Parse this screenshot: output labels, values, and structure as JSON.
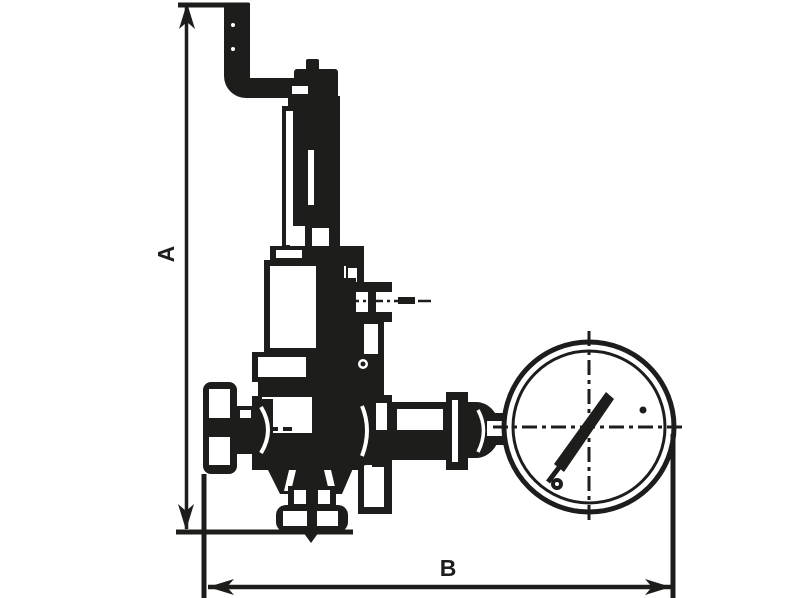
{
  "drawing": {
    "kind": "valve-dimensional-outline-drawing",
    "dimensions": {
      "vertical": {
        "label": "A"
      },
      "horizontal": {
        "label": "B"
      }
    },
    "parts": [
      "vent-pipe",
      "adjusting-cap",
      "spring-bonnet",
      "spring-housing",
      "side-plug",
      "valve-body",
      "inlet-union",
      "bottom-drain",
      "gauge-connection-pipe",
      "pressure-gauge",
      "gauge-needle"
    ]
  },
  "colors": {
    "ink": "#1d1d1b",
    "background": "#ffffff"
  }
}
